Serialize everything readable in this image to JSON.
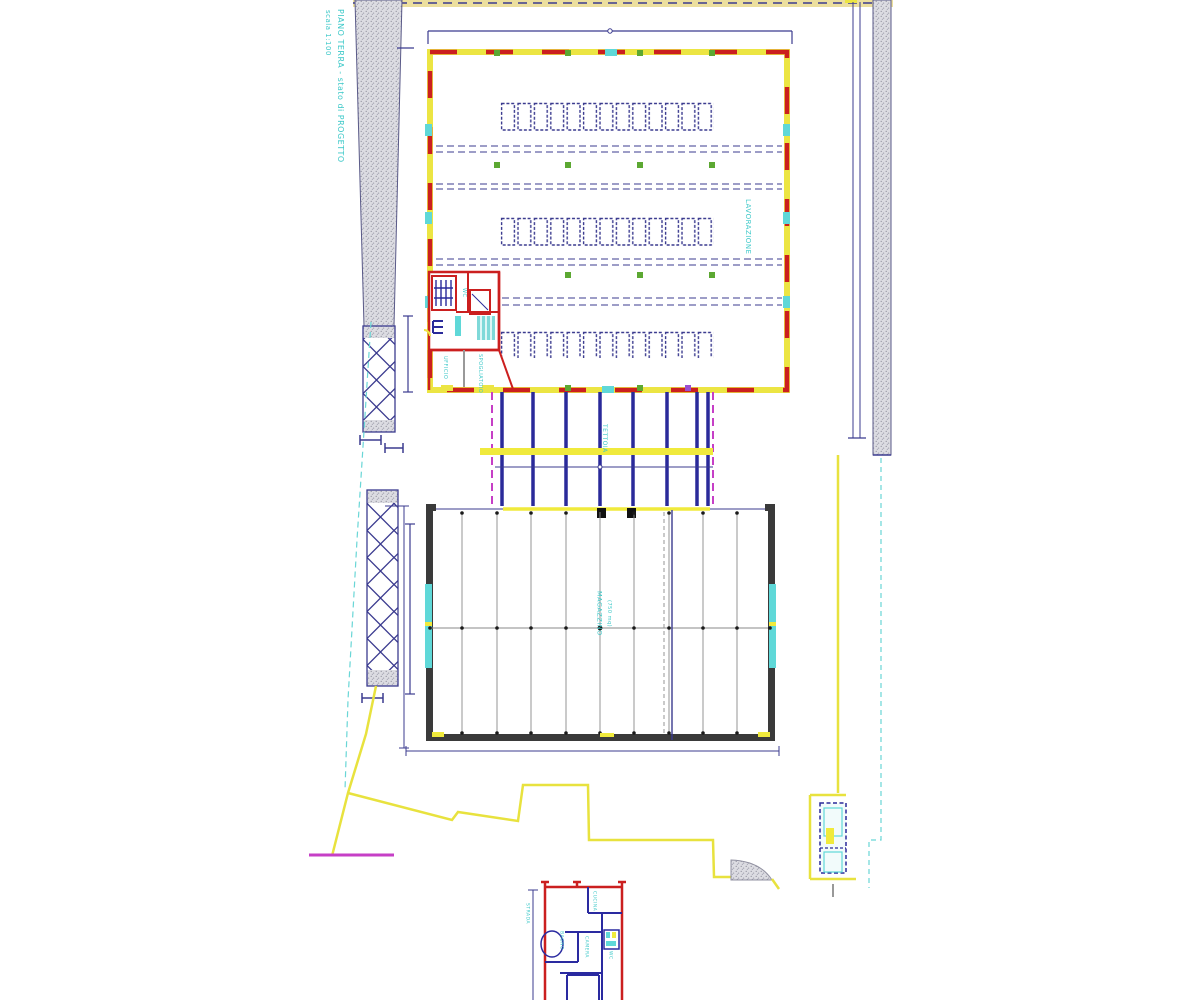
{
  "drawing": {
    "title": "PIANO TERRA  -  stato di PROGETTO",
    "scale_note": "scala 1:100",
    "areas": {
      "top_building_label": "LAVORAZIONE",
      "canopy_label": "TETTOIA",
      "warehouse_label": "MAGAZZINO",
      "warehouse_area": "(750 mq)"
    },
    "service_rooms": {
      "room_1": "UFFICIO",
      "room_2": "SPOGLIATOIO",
      "room_3": "WC"
    },
    "small_plan_rooms": {
      "room_1": "BAGNO",
      "room_2": "CUCINA",
      "room_3": "CAMERA",
      "room_4": "WC",
      "side_note": "STRADA"
    },
    "colors": {
      "cyan_text": "#3cc8c8",
      "wall_yellow": "#ece543",
      "fire_red": "#cb1f1f",
      "line_navy": "#3b3b8f",
      "column_blue": "#2a2a9a",
      "marker_green": "#5ca832",
      "magenta": "#c63fc6",
      "dark_wall": "#3a3a3a",
      "window_cyan": "#5fd8d8",
      "boundary_yellow": "#e8e23e",
      "hatch_gray": "#d8d8dc"
    }
  }
}
